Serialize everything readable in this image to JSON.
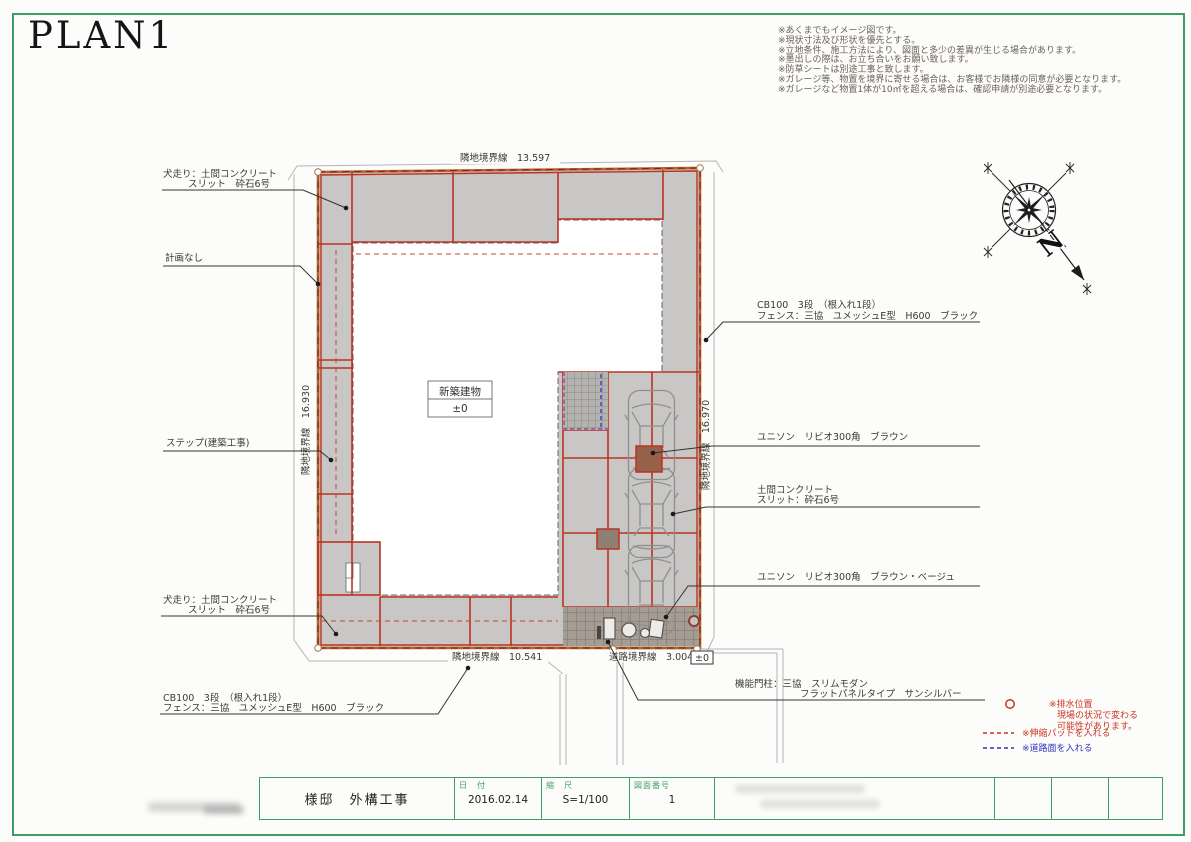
{
  "title": "PLAN1",
  "notes": [
    "※あくまでもイメージ図です。",
    "※現状寸法及び形状を優先とする。",
    "※立地条件、施工方法により、図面と多少の差異が生じる場合があります。",
    "※墨出しの際は、お立ち合いをお願い致します。",
    "※防草シートは別途工事と致します。",
    "※ガレージ等、物置を境界に寄せる場合は、お客様でお隣様の同意が必要となります。",
    "※ガレージなど物置1体が10㎡を超える場合は、確認申請が別途必要となります。"
  ],
  "compass": {
    "north": "N"
  },
  "plan": {
    "building_line1": "新築建物",
    "building_line2": "±0",
    "boundary_top": "隣地境界線　13.597",
    "boundary_left": "隣地境界線　16.930",
    "boundary_right": "隣地境界線　16.970",
    "boundary_bottom": "隣地境界線　10.541",
    "boundary_road": "道路境界線　3.004",
    "level_mark": "±0"
  },
  "callouts": {
    "dog_run_top": [
      "犬走り：土間コンクリート",
      "スリット　砕石6号"
    ],
    "no_plan": "計画なし",
    "step": "ステップ(建築工事)",
    "dog_run_bottom": [
      "犬走り：土間コンクリート",
      "スリット　砕石6号"
    ],
    "cb_fence_bottom": [
      "CB100　3段　（根入れ1段）",
      "フェンス：三協　ユメッシュE型　H600　ブラック"
    ],
    "cb_fence_right": [
      "CB100　3段　（根入れ1段）",
      "フェンス：三協　ユメッシュE型　H600　ブラック"
    ],
    "unison_brown": "ユニソン　リビオ300角　ブラウン",
    "slab_concrete": [
      "土間コンクリート",
      "スリット：砕石6号"
    ],
    "unison_brown_beige": "ユニソン　リビオ300角　ブラウン・ベージュ",
    "gate_pillar": [
      "機能門柱：三協　スリムモダン",
      "フラットパネルタイプ　サンシルバー"
    ]
  },
  "legend": {
    "drain_line1": "※排水位置",
    "drain_line2": "現場の状況で変わる",
    "drain_line3": "可能性があります。",
    "expansion_pad": "※伸縮パットを入れる",
    "road_surface": "※道路面を入れる"
  },
  "titleblock": {
    "project": "様邸　外構工事",
    "date_label": "日　付",
    "date_value": "2016.02.14",
    "scale_label": "縮　尺",
    "scale_value": "S=1/100",
    "sheet_label": "図面番号",
    "sheet_value": "1"
  },
  "colors": {
    "accent_green": "#3f9e63",
    "line_red": "#bb3322",
    "boundary_orange": "#b5622d",
    "legend_red": "#cc3322",
    "legend_blue": "#3333bb"
  }
}
